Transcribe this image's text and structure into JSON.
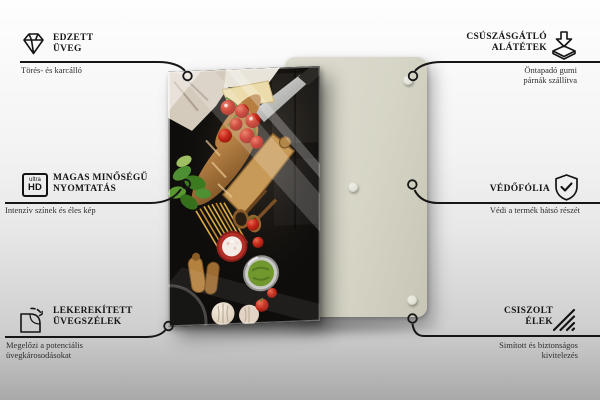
{
  "callouts": {
    "top_left": {
      "icon": "diamond-icon",
      "title": "EDZETT\nÜVEG",
      "subtitle": "Törés- és karcálló"
    },
    "top_right": {
      "icon": "anti-slip-pads-icon",
      "title": "CSÚSZÁSGÁTLÓ\nALÁTÉTEK",
      "subtitle": "Öntapadó gumi\npárnák szállítva"
    },
    "middle_left": {
      "icon": "ultra-hd-icon",
      "icon_text_top": "ultra",
      "icon_text_bottom": "HD",
      "title": "MAGAS MINŐSÉGŰ\nNYOMTATÁS",
      "subtitle": "Intenzív színek és éles kép"
    },
    "middle_right": {
      "icon": "shield-check-icon",
      "title": "VÉDŐFÓLIA",
      "subtitle": "Védi a termék hátsó részét"
    },
    "bottom_left": {
      "icon": "rounded-corner-icon",
      "title": "LEKEREKÍTETT\nÜVEGSZÉLEK",
      "subtitle": "Megelőzi a potenciális\nüvegkárosodásokat"
    },
    "bottom_right": {
      "icon": "polished-edges-icon",
      "title": "CSISZOLT\nÉLEK",
      "subtitle": "Simított és biztonságos\nkivitelezés"
    }
  },
  "product": {
    "front_panel": "glass board printed with italian food photo",
    "back_panel": "plain backing panel with rubber pads",
    "visible_pad_count": 3
  },
  "colors": {
    "background_top": "#fefefe",
    "background_bottom": "#a9a9a9",
    "back_panel": "#d6d5c6",
    "connector_line": "#161616",
    "title_text": "#161616",
    "subtitle_text": "#2e2e2e",
    "tomato_red": "#c22718",
    "pesto_green": "#6f9733",
    "basil_green": "#4e8f33",
    "bread_brown": "#b07a3e"
  }
}
